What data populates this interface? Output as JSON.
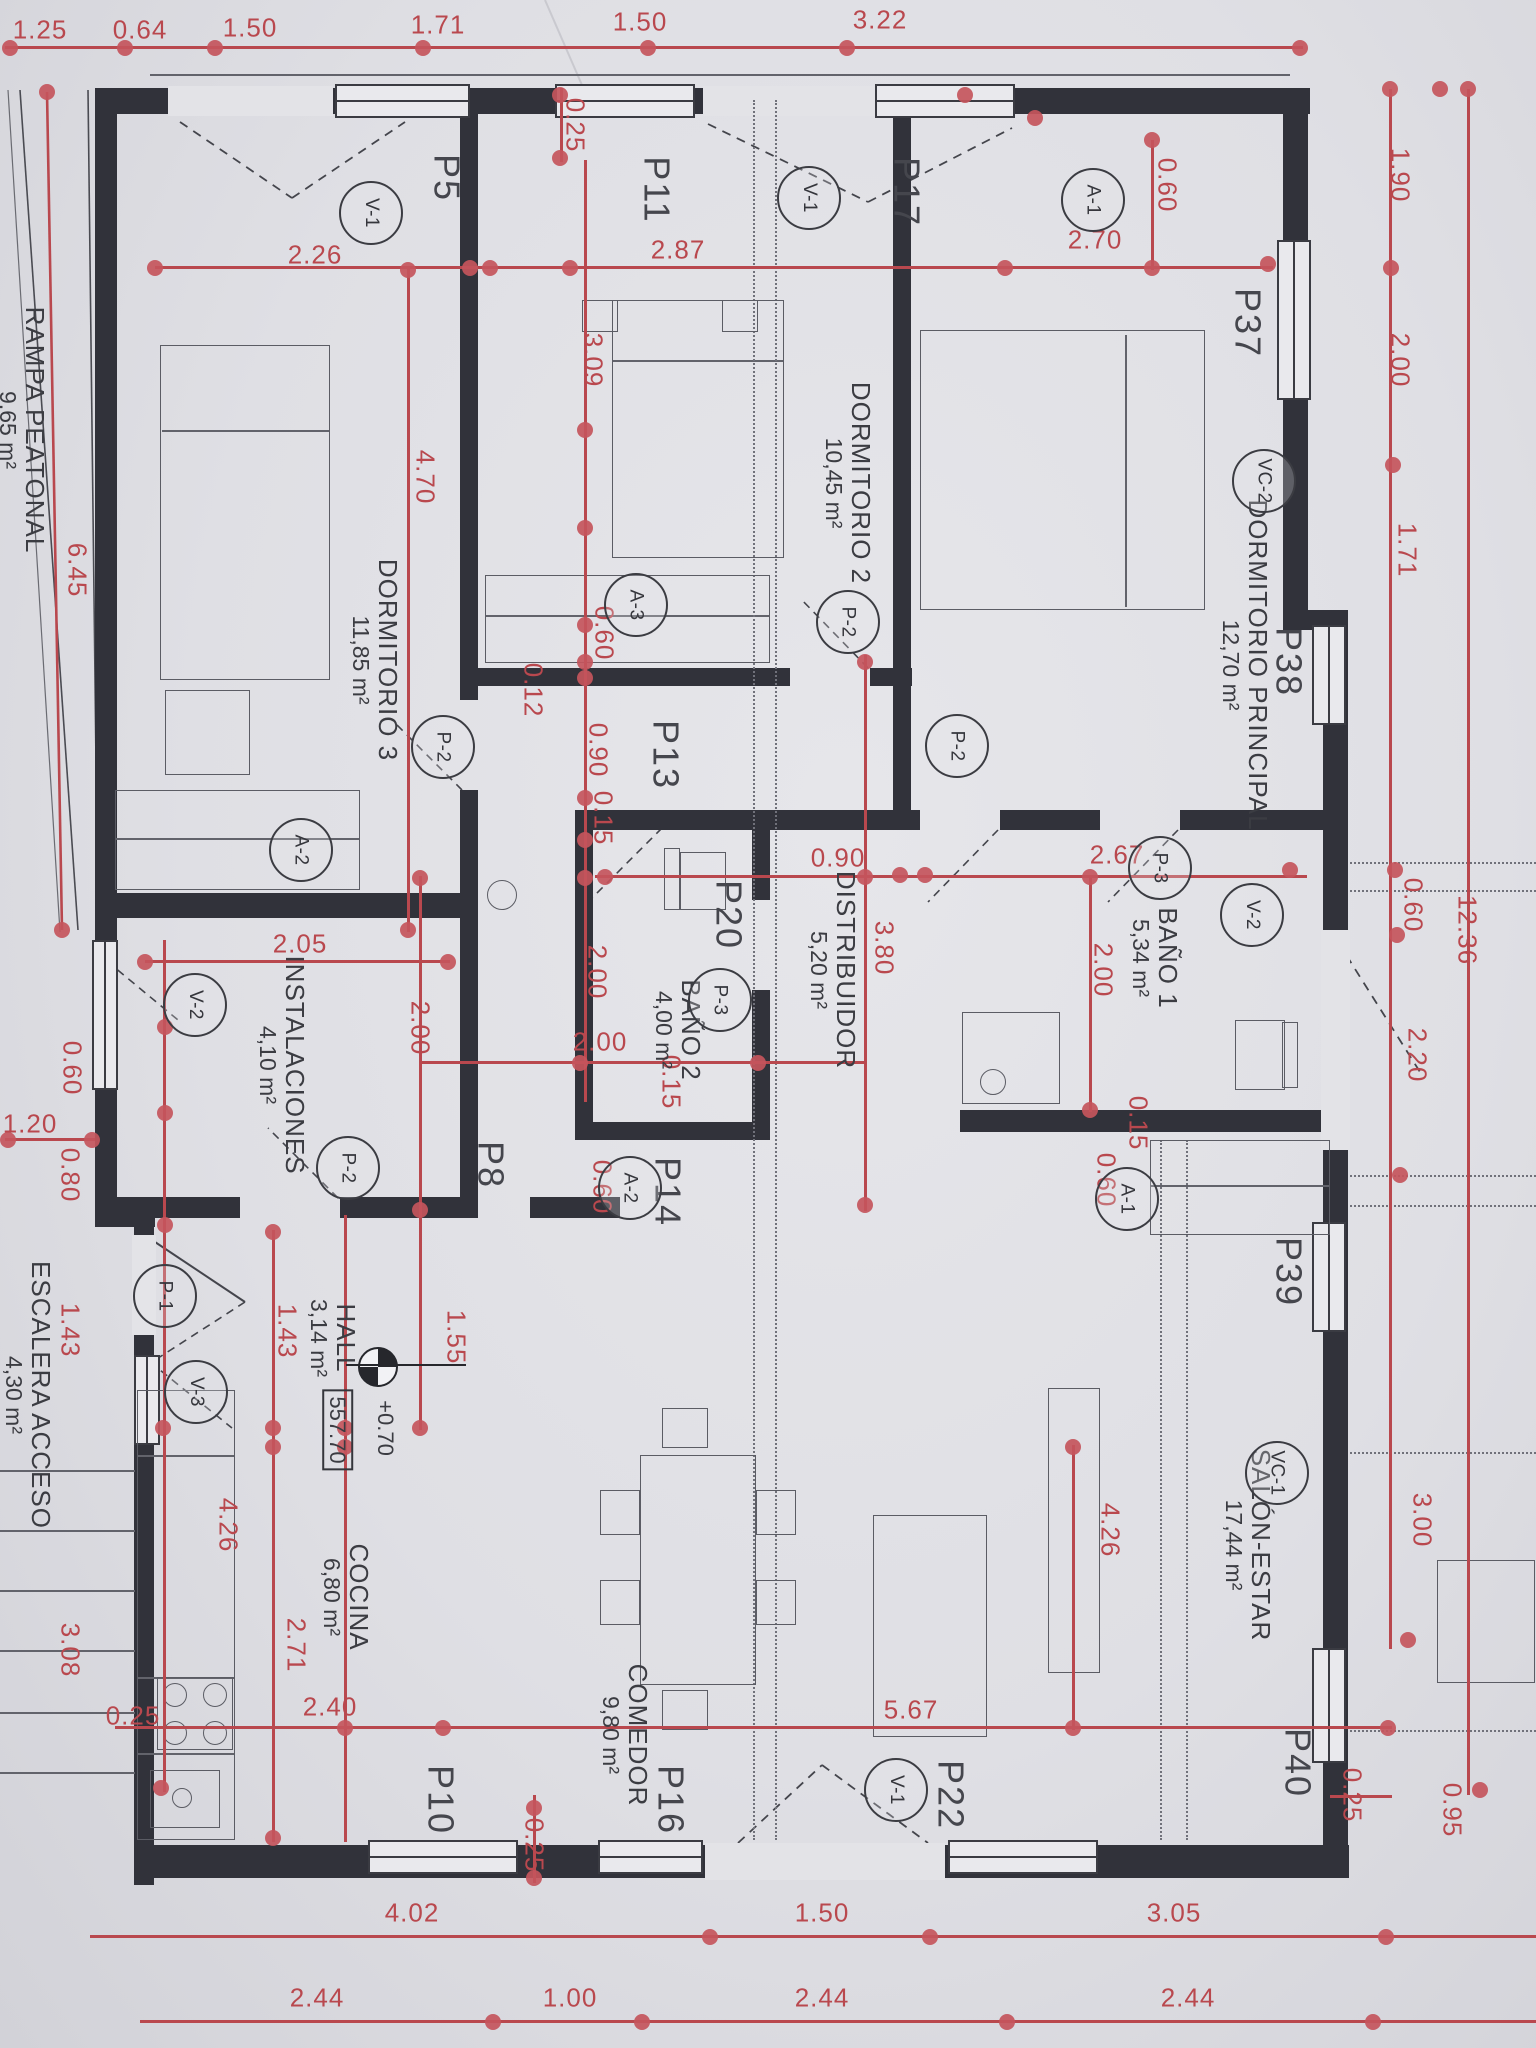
{
  "palette": {
    "paper": "#e3e3e7",
    "wall": "#31323a",
    "dim_red": "#b9484e",
    "text_black": "#3b3c42"
  },
  "rooms": [
    {
      "name": "DORMITORIO 3",
      "area": "11,85 m²",
      "x": 375,
      "y": 660
    },
    {
      "name": "DORMITORIO 2",
      "area": "10,45 m²",
      "x": 848,
      "y": 483
    },
    {
      "name": "DORMITORIO PRINCIPAL",
      "area": "12,70 m²",
      "x": 1245,
      "y": 665
    },
    {
      "name": "BAÑO 1",
      "area": "5,34 m²",
      "x": 1155,
      "y": 958
    },
    {
      "name": "BAÑO 2",
      "area": "4,00 m²",
      "x": 678,
      "y": 1030
    },
    {
      "name": "DISTRIBUIDOR",
      "area": "5,20 m²",
      "x": 833,
      "y": 970
    },
    {
      "name": "INSTALACIONES",
      "area": "4,10 m²",
      "x": 282,
      "y": 1065
    },
    {
      "name": "HALL",
      "area": "3,14 m²",
      "x": 333,
      "y": 1338
    },
    {
      "name": "COCINA",
      "area": "6,80 m²",
      "x": 346,
      "y": 1597
    },
    {
      "name": "COMEDOR",
      "area": "9,80 m²",
      "x": 625,
      "y": 1735
    },
    {
      "name": "SALÓN-ESTAR",
      "area": "17,44 m²",
      "x": 1248,
      "y": 1545
    },
    {
      "name": "RAMPA PEATONAL",
      "area": "9,65 m²",
      "x": 22,
      "y": 430
    },
    {
      "name": "ESCALERA ACCESO",
      "area": "4,30 m²",
      "x": 28,
      "y": 1395
    }
  ],
  "tags": [
    {
      "t": "V-1",
      "x": 371,
      "y": 213
    },
    {
      "t": "V-1",
      "x": 809,
      "y": 198
    },
    {
      "t": "A-1",
      "x": 1093,
      "y": 200
    },
    {
      "t": "VC-2",
      "x": 1264,
      "y": 481
    },
    {
      "t": "A-3",
      "x": 636,
      "y": 605
    },
    {
      "t": "P-2",
      "x": 848,
      "y": 622
    },
    {
      "t": "P-2",
      "x": 443,
      "y": 747
    },
    {
      "t": "P-2",
      "x": 957,
      "y": 746
    },
    {
      "t": "A-2",
      "x": 301,
      "y": 850
    },
    {
      "t": "P-3",
      "x": 1160,
      "y": 868
    },
    {
      "t": "V-2",
      "x": 1252,
      "y": 915
    },
    {
      "t": "P-3",
      "x": 720,
      "y": 1000
    },
    {
      "t": "V-2",
      "x": 195,
      "y": 1005
    },
    {
      "t": "A-1",
      "x": 1127,
      "y": 1199
    },
    {
      "t": "A-2",
      "x": 630,
      "y": 1188
    },
    {
      "t": "P-2",
      "x": 348,
      "y": 1168
    },
    {
      "t": "P-1",
      "x": 165,
      "y": 1296
    },
    {
      "t": "V-3",
      "x": 196,
      "y": 1392
    },
    {
      "t": "VC-1",
      "x": 1277,
      "y": 1473
    },
    {
      "t": "V-1",
      "x": 896,
      "y": 1790
    }
  ],
  "openings": [
    {
      "t": "P5",
      "x": 446,
      "y": 178
    },
    {
      "t": "P11",
      "x": 656,
      "y": 190
    },
    {
      "t": "P17",
      "x": 906,
      "y": 192
    },
    {
      "t": "P37",
      "x": 1247,
      "y": 323
    },
    {
      "t": "P38",
      "x": 1288,
      "y": 662
    },
    {
      "t": "P39",
      "x": 1288,
      "y": 1272
    },
    {
      "t": "P40",
      "x": 1297,
      "y": 1763
    },
    {
      "t": "P13",
      "x": 665,
      "y": 755
    },
    {
      "t": "P8",
      "x": 490,
      "y": 1165
    },
    {
      "t": "P14",
      "x": 667,
      "y": 1192
    },
    {
      "t": "P20",
      "x": 728,
      "y": 915
    },
    {
      "t": "P10",
      "x": 440,
      "y": 1800
    },
    {
      "t": "P16",
      "x": 670,
      "y": 1800
    },
    {
      "t": "P22",
      "x": 950,
      "y": 1795
    }
  ],
  "dims_h": [
    {
      "t": "1.25",
      "x": 40,
      "y": 30
    },
    {
      "t": "0.64",
      "x": 140,
      "y": 30
    },
    {
      "t": "1.50",
      "x": 250,
      "y": 28
    },
    {
      "t": "1.71",
      "x": 438,
      "y": 25
    },
    {
      "t": "1.50",
      "x": 640,
      "y": 22
    },
    {
      "t": "3.22",
      "x": 880,
      "y": 20
    },
    {
      "t": "2.26",
      "x": 315,
      "y": 255
    },
    {
      "t": "2.87",
      "x": 678,
      "y": 250
    },
    {
      "t": "2.70",
      "x": 1095,
      "y": 240
    },
    {
      "t": "2.05",
      "x": 300,
      "y": 944
    },
    {
      "t": "0.90",
      "x": 838,
      "y": 858
    },
    {
      "t": "2.67",
      "x": 1117,
      "y": 855
    },
    {
      "t": "2.00",
      "x": 600,
      "y": 1042
    },
    {
      "t": "1.20",
      "x": 30,
      "y": 1124
    },
    {
      "t": "2.40",
      "x": 330,
      "y": 1707
    },
    {
      "t": "5.67",
      "x": 911,
      "y": 1710
    },
    {
      "t": "0.25",
      "x": 133,
      "y": 1716
    },
    {
      "t": "4.02",
      "x": 412,
      "y": 1913
    },
    {
      "t": "1.50",
      "x": 822,
      "y": 1913
    },
    {
      "t": "3.05",
      "x": 1174,
      "y": 1913
    },
    {
      "t": "2.44",
      "x": 317,
      "y": 1998
    },
    {
      "t": "1.00",
      "x": 570,
      "y": 1998
    },
    {
      "t": "2.44",
      "x": 822,
      "y": 1998
    },
    {
      "t": "2.44",
      "x": 1188,
      "y": 1998
    }
  ],
  "dims_v": [
    {
      "t": "0.25",
      "x": 575,
      "y": 125
    },
    {
      "t": "1.90",
      "x": 1400,
      "y": 175
    },
    {
      "t": "2.00",
      "x": 1400,
      "y": 360
    },
    {
      "t": "1.71",
      "x": 1407,
      "y": 550
    },
    {
      "t": "0.60",
      "x": 1413,
      "y": 905
    },
    {
      "t": "2.20",
      "x": 1417,
      "y": 1055
    },
    {
      "t": "12.36",
      "x": 1467,
      "y": 930
    },
    {
      "t": "3.00",
      "x": 1422,
      "y": 1520
    },
    {
      "t": "0.95",
      "x": 1452,
      "y": 1810
    },
    {
      "t": "0.25",
      "x": 1352,
      "y": 1795
    },
    {
      "t": "6.45",
      "x": 77,
      "y": 570
    },
    {
      "t": "0.60",
      "x": 72,
      "y": 1068
    },
    {
      "t": "0.80",
      "x": 70,
      "y": 1175
    },
    {
      "t": "1.43",
      "x": 70,
      "y": 1330
    },
    {
      "t": "3.08",
      "x": 70,
      "y": 1650
    },
    {
      "t": "4.70",
      "x": 425,
      "y": 477
    },
    {
      "t": "3.09",
      "x": 593,
      "y": 360
    },
    {
      "t": "0.60",
      "x": 604,
      "y": 633
    },
    {
      "t": "0.12",
      "x": 533,
      "y": 690
    },
    {
      "t": "0.90",
      "x": 598,
      "y": 750
    },
    {
      "t": "0.15",
      "x": 603,
      "y": 818
    },
    {
      "t": "2.00",
      "x": 597,
      "y": 972
    },
    {
      "t": "3.80",
      "x": 884,
      "y": 948
    },
    {
      "t": "2.00",
      "x": 1103,
      "y": 970
    },
    {
      "t": "0.15",
      "x": 1138,
      "y": 1123
    },
    {
      "t": "0.60",
      "x": 1106,
      "y": 1180
    },
    {
      "t": "0.60",
      "x": 1167,
      "y": 185
    },
    {
      "t": "0.15",
      "x": 671,
      "y": 1082
    },
    {
      "t": "0.60",
      "x": 602,
      "y": 1187
    },
    {
      "t": "2.00",
      "x": 420,
      "y": 1028
    },
    {
      "t": "1.55",
      "x": 456,
      "y": 1337
    },
    {
      "t": "1.43",
      "x": 287,
      "y": 1331
    },
    {
      "t": "4.26",
      "x": 228,
      "y": 1525
    },
    {
      "t": "2.71",
      "x": 296,
      "y": 1645
    },
    {
      "t": "4.26",
      "x": 1110,
      "y": 1530
    },
    {
      "t": "0.25",
      "x": 534,
      "y": 1845
    }
  ],
  "level_marker": {
    "x": 376,
    "y": 1365,
    "elevation": "+0.70",
    "value": "557.70",
    "ex": 385,
    "ey": 1428,
    "vx": 337,
    "vy": 1430
  },
  "red_lines": [
    [
      5,
      46,
      1298,
      3
    ],
    [
      155,
      266,
      1118,
      3
    ],
    [
      595,
      875,
      712,
      3
    ],
    [
      145,
      960,
      305,
      3
    ],
    [
      420,
      1061,
      447,
      3
    ],
    [
      5,
      1138,
      90,
      3
    ],
    [
      115,
      1726,
      1277,
      3
    ],
    [
      90,
      1935,
      1446,
      3
    ],
    [
      140,
      2020,
      1396,
      3
    ],
    [
      560,
      88,
      3,
      74
    ],
    [
      1389,
      89,
      3,
      1560
    ],
    [
      1467,
      89,
      3,
      1706
    ],
    [
      163,
      940,
      3,
      852
    ],
    [
      272,
      1230,
      3,
      612
    ],
    [
      344,
      1215,
      3,
      627
    ],
    [
      419,
      876,
      3,
      554
    ],
    [
      584,
      160,
      3,
      942
    ],
    [
      864,
      655,
      3,
      556
    ],
    [
      1089,
      875,
      3,
      237
    ],
    [
      1151,
      140,
      3,
      130
    ],
    [
      407,
      268,
      3,
      664
    ],
    [
      1072,
      1445,
      3,
      285
    ],
    [
      533,
      1795,
      3,
      88
    ],
    [
      1330,
      1795,
      62,
      3
    ]
  ],
  "red_dots": [
    [
      10,
      48
    ],
    [
      125,
      48
    ],
    [
      215,
      48
    ],
    [
      423,
      48
    ],
    [
      648,
      48
    ],
    [
      847,
      48
    ],
    [
      1300,
      48
    ],
    [
      155,
      268
    ],
    [
      470,
      268
    ],
    [
      490,
      268
    ],
    [
      570,
      268
    ],
    [
      1005,
      268
    ],
    [
      1152,
      268
    ],
    [
      1268,
      264
    ],
    [
      560,
      95
    ],
    [
      560,
      158
    ],
    [
      1152,
      140
    ],
    [
      1390,
      89
    ],
    [
      1440,
      89
    ],
    [
      1391,
      268
    ],
    [
      1393,
      465
    ],
    [
      1395,
      870
    ],
    [
      1397,
      935
    ],
    [
      1400,
      1175
    ],
    [
      1408,
      1640
    ],
    [
      1468,
      89
    ],
    [
      1480,
      1790
    ],
    [
      47,
      92
    ],
    [
      62,
      930
    ],
    [
      165,
      1027
    ],
    [
      165,
      1113
    ],
    [
      165,
      1225
    ],
    [
      163,
      1428
    ],
    [
      161,
      1788
    ],
    [
      605,
      877
    ],
    [
      900,
      875
    ],
    [
      925,
      875
    ],
    [
      1090,
      877
    ],
    [
      1290,
      870
    ],
    [
      145,
      962
    ],
    [
      448,
      962
    ],
    [
      580,
      1063
    ],
    [
      758,
      1063
    ],
    [
      345,
      1428
    ],
    [
      345,
      1447
    ],
    [
      273,
      1428
    ],
    [
      273,
      1447
    ],
    [
      273,
      1232
    ],
    [
      273,
      1838
    ],
    [
      345,
      1728
    ],
    [
      443,
      1728
    ],
    [
      1073,
      1728
    ],
    [
      1388,
      1728
    ],
    [
      710,
      1937
    ],
    [
      930,
      1937
    ],
    [
      1386,
      1937
    ],
    [
      493,
      2022
    ],
    [
      642,
      2022
    ],
    [
      1007,
      2022
    ],
    [
      1373,
      2022
    ],
    [
      408,
      270
    ],
    [
      408,
      930
    ],
    [
      585,
      430
    ],
    [
      585,
      528
    ],
    [
      585,
      625
    ],
    [
      585,
      662
    ],
    [
      585,
      678
    ],
    [
      585,
      798
    ],
    [
      585,
      840
    ],
    [
      585,
      878
    ],
    [
      865,
      662
    ],
    [
      865,
      877
    ],
    [
      865,
      1205
    ],
    [
      420,
      878
    ],
    [
      420,
      1210
    ],
    [
      420,
      1428
    ],
    [
      1090,
      1110
    ],
    [
      1073,
      1447
    ],
    [
      534,
      1808
    ],
    [
      534,
      1878
    ],
    [
      8,
      1140
    ],
    [
      92,
      1140
    ],
    [
      965,
      95
    ],
    [
      1035,
      118
    ]
  ],
  "walls": [
    [
      95,
      88,
      1215,
      26
    ],
    [
      95,
      88,
      22,
      1130
    ],
    [
      95,
      1205,
      60,
      22
    ],
    [
      134,
      1205,
      20,
      680
    ],
    [
      134,
      1845,
      1215,
      33
    ],
    [
      1283,
      88,
      25,
      540
    ],
    [
      1283,
      610,
      65,
      20
    ],
    [
      1323,
      610,
      25,
      1268
    ],
    [
      460,
      95,
      18,
      605
    ],
    [
      460,
      790,
      18,
      128
    ],
    [
      478,
      668,
      312,
      18
    ],
    [
      870,
      668,
      42,
      18
    ],
    [
      108,
      893,
      352,
      25
    ],
    [
      108,
      1197,
      132,
      21
    ],
    [
      340,
      1197,
      120,
      21
    ],
    [
      460,
      918,
      18,
      300
    ],
    [
      582,
      810,
      338,
      20
    ],
    [
      1000,
      810,
      100,
      20
    ],
    [
      1180,
      810,
      150,
      20
    ],
    [
      960,
      1110,
      390,
      22
    ],
    [
      893,
      95,
      18,
      715
    ],
    [
      575,
      810,
      18,
      330
    ],
    [
      752,
      810,
      18,
      90
    ],
    [
      752,
      990,
      18,
      150
    ],
    [
      575,
      1122,
      195,
      18
    ],
    [
      530,
      1197,
      90,
      21
    ]
  ],
  "gaps": [
    [
      168,
      86,
      165,
      30
    ],
    [
      703,
      86,
      172,
      30
    ],
    [
      705,
      1843,
      240,
      37
    ],
    [
      1321,
      930,
      29,
      220
    ],
    [
      132,
      1235,
      24,
      100
    ]
  ],
  "windows": [
    [
      335,
      84,
      135,
      34
    ],
    [
      555,
      84,
      140,
      34
    ],
    [
      875,
      84,
      140,
      34
    ],
    [
      1277,
      240,
      34,
      160
    ],
    [
      1312,
      625,
      34,
      100
    ],
    [
      1312,
      1222,
      34,
      110
    ],
    [
      1312,
      1648,
      34,
      115
    ],
    [
      368,
      1840,
      150,
      34
    ],
    [
      598,
      1840,
      105,
      34
    ],
    [
      948,
      1840,
      150,
      34
    ],
    [
      92,
      940,
      26,
      150
    ],
    [
      134,
      1355,
      26,
      90
    ]
  ],
  "furniture_rects": [
    [
      160,
      345,
      170,
      335
    ],
    [
      165,
      690,
      85,
      85
    ],
    [
      612,
      300,
      172,
      258
    ],
    [
      582,
      300,
      36,
      32
    ],
    [
      722,
      300,
      36,
      32
    ],
    [
      920,
      330,
      285,
      280
    ],
    [
      485,
      575,
      285,
      88
    ],
    [
      115,
      790,
      245,
      100
    ],
    [
      1150,
      1140,
      180,
      95
    ],
    [
      962,
      1012,
      98,
      92
    ],
    [
      1235,
      1020,
      50,
      70
    ],
    [
      1282,
      1022,
      16,
      66
    ],
    [
      664,
      848,
      16,
      62
    ],
    [
      680,
      852,
      46,
      58
    ],
    [
      157,
      1677,
      76,
      73
    ],
    [
      137,
      1390,
      98,
      450
    ],
    [
      150,
      1770,
      70,
      58
    ],
    [
      640,
      1455,
      116,
      230
    ],
    [
      600,
      1490,
      40,
      45
    ],
    [
      600,
      1580,
      40,
      45
    ],
    [
      756,
      1490,
      40,
      45
    ],
    [
      756,
      1580,
      40,
      45
    ],
    [
      662,
      1408,
      46,
      40
    ],
    [
      662,
      1690,
      46,
      40
    ],
    [
      1048,
      1388,
      52,
      285
    ],
    [
      873,
      1515,
      114,
      222
    ],
    [
      1437,
      1560,
      98,
      123
    ]
  ],
  "furniture_circles": [
    [
      993,
      1082,
      13
    ],
    [
      502,
      895,
      15
    ],
    [
      175,
      1695,
      12
    ],
    [
      215,
      1695,
      12
    ],
    [
      175,
      1733,
      12
    ],
    [
      215,
      1733,
      12
    ],
    [
      182,
      1798,
      10
    ]
  ],
  "thin_lines": [
    [
      485,
      615,
      285,
      2
    ],
    [
      115,
      838,
      245,
      2
    ],
    [
      1150,
      1185,
      180,
      2
    ],
    [
      162,
      430,
      168,
      2
    ],
    [
      612,
      360,
      172,
      2
    ],
    [
      1125,
      335,
      2,
      272
    ],
    [
      137,
      1455,
      98,
      2
    ],
    [
      137,
      1677,
      98,
      2
    ],
    [
      137,
      1753,
      98,
      2
    ],
    [
      150,
      74,
      1140,
      2
    ],
    [
      0,
      1470,
      135,
      2
    ],
    [
      0,
      1530,
      135,
      2
    ],
    [
      0,
      1590,
      135,
      2
    ],
    [
      0,
      1650,
      135,
      2
    ],
    [
      0,
      1712,
      135,
      2
    ],
    [
      0,
      1772,
      135,
      2
    ]
  ],
  "dotted_lines": [
    {
      "x": 753,
      "y": 100,
      "len": 1740,
      "dir": "v"
    },
    {
      "x": 775,
      "y": 100,
      "len": 1740,
      "dir": "v"
    },
    {
      "x": 1160,
      "y": 1140,
      "len": 700,
      "dir": "v"
    },
    {
      "x": 1186,
      "y": 1140,
      "len": 700,
      "dir": "v"
    },
    {
      "x": 1350,
      "y": 862,
      "len": 186,
      "dir": "h"
    },
    {
      "x": 1350,
      "y": 890,
      "len": 186,
      "dir": "h"
    },
    {
      "x": 1350,
      "y": 1175,
      "len": 186,
      "dir": "h"
    },
    {
      "x": 1350,
      "y": 1205,
      "len": 186,
      "dir": "h"
    },
    {
      "x": 1350,
      "y": 1452,
      "len": 186,
      "dir": "h"
    },
    {
      "x": 1350,
      "y": 1730,
      "len": 186,
      "dir": "h"
    }
  ],
  "svg_paths": [
    {
      "d": "M20 90 L78 930",
      "dash": "none",
      "col": "#4a4b52",
      "w": 1.6
    },
    {
      "d": "M8 90 L60 932",
      "dash": "none",
      "col": "#6a6b72",
      "w": 1.2
    },
    {
      "d": "M88 90 L98 932",
      "dash": "none",
      "col": "#4a4b52",
      "w": 1.6
    },
    {
      "d": "M47 92 L62 930",
      "dash": "none",
      "col": "#b9484e",
      "w": 2.6
    },
    {
      "d": "M545 0 L585 92",
      "dash": "none",
      "col": "#c9c9cf",
      "w": 2
    },
    {
      "d": "M180 122 L292 198 M292 198 L405 122",
      "dash": "9 7",
      "col": "#44454c",
      "w": 1.8
    },
    {
      "d": "M708 124 L868 202 M868 202 L1012 128",
      "dash": "9 7",
      "col": "#44454c",
      "w": 1.8
    },
    {
      "d": "M738 1843 L822 1765 M822 1765 L928 1843",
      "dash": "9 7",
      "col": "#44454c",
      "w": 1.8
    },
    {
      "d": "M1338 942 L1420 1072",
      "dash": "9 7",
      "col": "#44454c",
      "w": 1.8
    },
    {
      "d": "M152 1240 L245 1302",
      "dash": "none",
      "col": "#44454c",
      "w": 2
    },
    {
      "d": "M245 1302 L152 1362",
      "dash": "8 6",
      "col": "#44454c",
      "w": 1.6
    },
    {
      "d": "M96 952 L178 1020",
      "dash": "8 6",
      "col": "#44454c",
      "w": 1.6
    },
    {
      "d": "M150 1362 L232 1428",
      "dash": "8 6",
      "col": "#44454c",
      "w": 1.6
    },
    {
      "d": "M662 828 L592 898",
      "dash": "8 6",
      "col": "#44454c",
      "w": 1.6
    },
    {
      "d": "M998 830 L928 902",
      "dash": "8 6",
      "col": "#44454c",
      "w": 1.6
    },
    {
      "d": "M1178 830 L1108 902",
      "dash": "8 6",
      "col": "#44454c",
      "w": 1.6
    },
    {
      "d": "M868 668 L800 598",
      "dash": "8 6",
      "col": "#44454c",
      "w": 1.6
    },
    {
      "d": "M462 790 L392 720",
      "dash": "8 6",
      "col": "#44454c",
      "w": 1.6
    },
    {
      "d": "M338 1198 L268 1128",
      "dash": "8 6",
      "col": "#44454c",
      "w": 1.6
    }
  ]
}
